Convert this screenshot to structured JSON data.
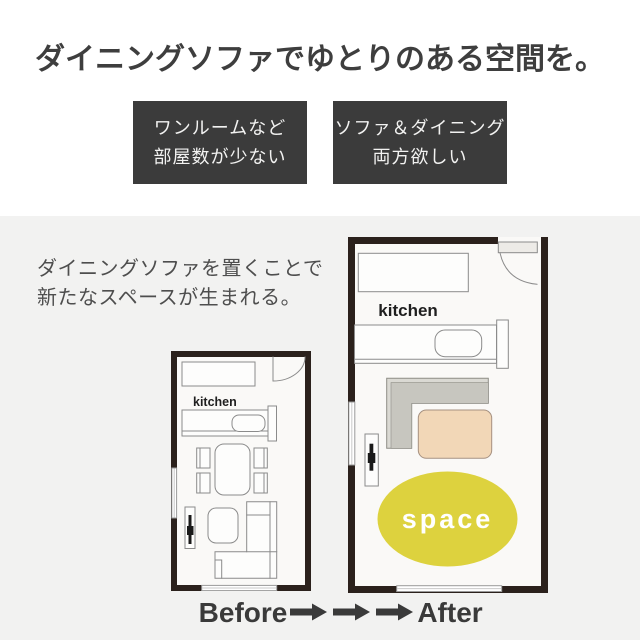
{
  "header": {
    "title": "ダイニングソファでゆとりのある空間を。"
  },
  "tags": [
    {
      "lines": [
        "ワンルームなど",
        "部屋数が少ない"
      ]
    },
    {
      "lines": [
        "ソファ＆ダイニング",
        "両方欲しい"
      ]
    }
  ],
  "description": {
    "lines": [
      "ダイニングソファを置くことで",
      "新たなスペースが生まれる。"
    ]
  },
  "before_plan": {
    "kitchen_label": "kitchen"
  },
  "after_plan": {
    "kitchen_label": "kitchen",
    "space_label": "space"
  },
  "footer": {
    "before_label": "Before",
    "after_label": "After",
    "arrow_count": 3
  },
  "colors": {
    "tag_background": "#3b3b3b",
    "tag_text": "#f2f2f1",
    "wall": "#2b211c",
    "floor": "#faf9f7",
    "furniture_stroke": "#8b8b8b",
    "space_yellow": "#ddd23e",
    "table_peach": "#f2d7b7",
    "table_stroke": "#a69181",
    "sofa_light": "#dad9d3",
    "sofa_dark": "#c7c6bf",
    "background_bottom": "#f2f2f1",
    "background_top": "#ffffff",
    "text_dark": "#3e3e3e"
  }
}
